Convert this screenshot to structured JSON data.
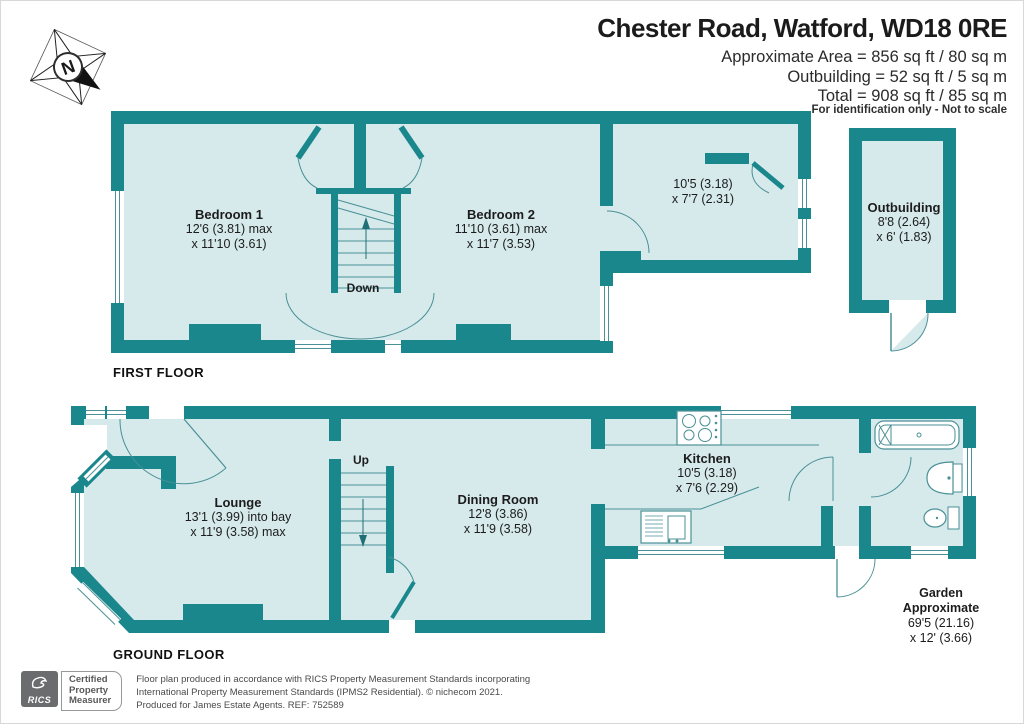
{
  "header": {
    "title": "Chester Road, Watford, WD18 0RE",
    "area_line_1": "Approximate Area = 856 sq ft / 80 sq m",
    "area_line_2": "Outbuilding = 52 sq ft / 5 sq m",
    "area_line_3": "Total = 908 sq ft / 85 sq m",
    "note": "For identification only - Not to scale"
  },
  "compass": {
    "north_label": "N"
  },
  "first_floor": {
    "label": "FIRST FLOOR",
    "bedroom1": {
      "name": "Bedroom 1",
      "dim1": "12'6 (3.81) max",
      "dim2": "x 11'10 (3.61)"
    },
    "bedroom2": {
      "name": "Bedroom 2",
      "dim1": "11'10 (3.61) max",
      "dim2": "x 11'7 (3.53)"
    },
    "room3": {
      "dim1": "10'5 (3.18)",
      "dim2": "x 7'7 (2.31)"
    },
    "stairs_label": "Down"
  },
  "ground_floor": {
    "label": "GROUND FLOOR",
    "lounge": {
      "name": "Lounge",
      "dim1": "13'1 (3.99) into bay",
      "dim2": "x 11'9 (3.58) max"
    },
    "dining": {
      "name": "Dining Room",
      "dim1": "12'8 (3.86)",
      "dim2": "x 11'9 (3.58)"
    },
    "kitchen": {
      "name": "Kitchen",
      "dim1": "10'5 (3.18)",
      "dim2": "x 7'6 (2.29)"
    },
    "stairs_label": "Up",
    "garden": {
      "name": "Garden",
      "name2": "Approximate",
      "dim1": "69'5 (21.16)",
      "dim2": "x 12' (3.66)"
    }
  },
  "outbuilding": {
    "name": "Outbuilding",
    "dim1": "8'8 (2.64)",
    "dim2": "x 6' (1.83)"
  },
  "footer": {
    "rics_label": "RICS",
    "cert_line_1": "Certified",
    "cert_line_2": "Property",
    "cert_line_3": "Measurer",
    "line_1": "Floor plan produced in accordance with RICS Property Measurement Standards incorporating",
    "line_2": "International Property Measurement Standards (IPMS2 Residential).  © nichecom 2021.",
    "line_3": "Produced for James Estate Agents.   REF: 752589"
  },
  "colors": {
    "wall": "#19878c",
    "floor": "#d6eaec",
    "line": "#4a9096"
  }
}
